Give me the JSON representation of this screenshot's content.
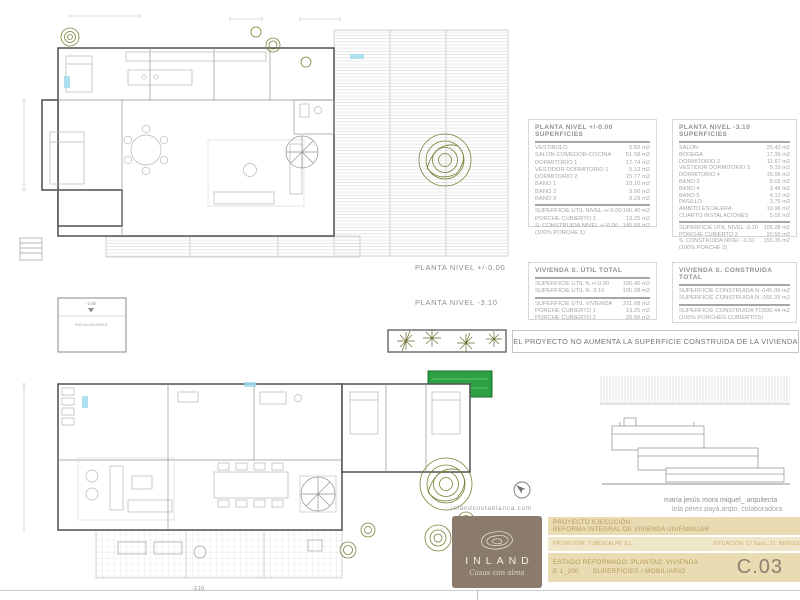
{
  "sheet": {
    "plan_labels": {
      "level0": "PLANTA NIVEL +/-0.00",
      "level310": "PLANTA NIVEL -3.10"
    },
    "micro": {
      "instal_label": "INSTALACIONES",
      "level_246": "-2.46",
      "level_310": "-3.10"
    }
  },
  "tables": {
    "level0": {
      "title": "PLANTA NIVEL +/-0.00 SUPERFICIES",
      "rows": [
        {
          "label": "VESTIBULO",
          "value": "5.82 m2"
        },
        {
          "label": "SALÓN-COMEDOR-COCINA",
          "value": "51.58 m2"
        },
        {
          "label": "DORMITORIO 1",
          "value": "17.74 m2"
        },
        {
          "label": "VESTIDOR DORMITORIO 1",
          "value": "5.12 m2"
        },
        {
          "label": "DORMITORIO 2",
          "value": "15.77 m2"
        },
        {
          "label": "BAÑO 1",
          "value": "10.10 m2"
        },
        {
          "label": "BAÑO 2",
          "value": "3.00 m2"
        },
        {
          "label": "BAÑO 3",
          "value": "3.29 m2"
        }
      ],
      "totals": [
        {
          "label": "SUPERFICIE ÚTIL NIVEL +/-0.00",
          "value": "106.40 m2"
        },
        {
          "label": "PORCHE CUBIERTO 1",
          "value": "13.25 m2"
        }
      ],
      "built": [
        {
          "label": "S. CONSTRUIDA NIVEL +/-0.00",
          "value": "145.09 m2"
        },
        {
          "label": "(100% PORCHE 1)",
          "value": ""
        }
      ]
    },
    "level310": {
      "title": "PLANTA NIVEL -3.10  SUPERFICIES",
      "rows": [
        {
          "label": "SALÓN",
          "value": "25.43 m2"
        },
        {
          "label": "BODEGA",
          "value": "17.36 m2"
        },
        {
          "label": "DORMITORIO 3",
          "value": "11.67 m2"
        },
        {
          "label": "VESTIDOR DORMITORIO 3",
          "value": "5.19 m2"
        },
        {
          "label": "DORMITORIO 4",
          "value": "15.06 m2"
        },
        {
          "label": "BAÑO 3",
          "value": "5.05 m2"
        },
        {
          "label": "BAÑO 4",
          "value": "3.46 m2"
        },
        {
          "label": "BAÑO 5",
          "value": "4.13 m2"
        },
        {
          "label": "PASILLO",
          "value": "3.75 m2"
        },
        {
          "label": "ÁMBITO ESCALERA",
          "value": "10.96 m2"
        },
        {
          "label": "CUARTO INSTALACIONES",
          "value": "5.02 m2"
        }
      ],
      "totals": [
        {
          "label": "SUPERFICIE ÚTIL NIVEL -3.10",
          "value": "105.28 m2"
        },
        {
          "label": "PORCHE CUBIERTO 2",
          "value": "20.56 m2"
        }
      ],
      "built": [
        {
          "label": "S. CONSTRUIDA NIVEL -3.10",
          "value": "155.35 m2"
        },
        {
          "label": "(100% PORCHE 2)",
          "value": ""
        }
      ]
    },
    "util_total": {
      "title": "VIVIENDA S. ÚTIL TOTAL",
      "rows": [
        {
          "label": "SUPERFICIE ÚTIL N.+/-0.00",
          "value": "106.40 m2"
        },
        {
          "label": "SUPERFICIE ÚTIL N.-3.10",
          "value": "105.28 m2"
        }
      ],
      "totals": [
        {
          "label": "SUPERFICIE ÚTIL VIVIENDA",
          "value": "211.68 m2"
        },
        {
          "label": "PORCHE CUBIERTO 1",
          "value": "13.25 m2"
        },
        {
          "label": "PORCHE CUBIERTO 2",
          "value": "20.56 m2"
        }
      ]
    },
    "built_total": {
      "title": "VIVIENDA S. CONSTRUIDA TOTAL",
      "rows": [
        {
          "label": "SUPERFICIE CONSTRUIDA N.+/-0.00",
          "value": "145.09 m2"
        },
        {
          "label": "SUPERFICIE CONSTRUIDA N.-3.10",
          "value": "155.35 m2"
        }
      ],
      "totals": [
        {
          "label": "SUPERFICIE CONSTRUIDA  TOTAL",
          "value": "300.44 m2"
        },
        {
          "label": "(100% PORCHES CUBIERTOS)",
          "value": ""
        }
      ]
    }
  },
  "banner": {
    "text": "EL PROYECTO NO AUMENTA LA SUPERFICIE CONSTRUIDA DE LA VIVIENDA"
  },
  "credits": {
    "architect": "maría jesús mora miquel_ arquitecta",
    "collaborator": "lola pérez payá.arqto. colaboradora"
  },
  "brand": {
    "website": "inlandcostablanca.com",
    "name": "INLAND",
    "tagline": "Casas con alma"
  },
  "titleblock": {
    "project_label": "PROYECTO EJECUCIÓN:",
    "project_name": "REFORMA INTEGRAL DE VIVIENDA UNIFAMILIAR",
    "promoter": "PROMOTOR: TUBISCALPE S.L.",
    "location": "SITUACIÓN: C/ Sauc, 31. BENISSA",
    "state": "ESTADO REFORMADO: PLANTAS: VIVIENDA",
    "scale": "E 1_100",
    "subtitle": "SUPERFICIES / MOBILIARIO",
    "code": "C.03"
  },
  "colors": {
    "accent_beige": "#e9dbb2",
    "brand_taupe": "#8a7b6d",
    "pool_green": "#2da043",
    "plan_olive": "#767a2c",
    "title_text": "#b49b5b",
    "code_text": "#8e8172"
  }
}
